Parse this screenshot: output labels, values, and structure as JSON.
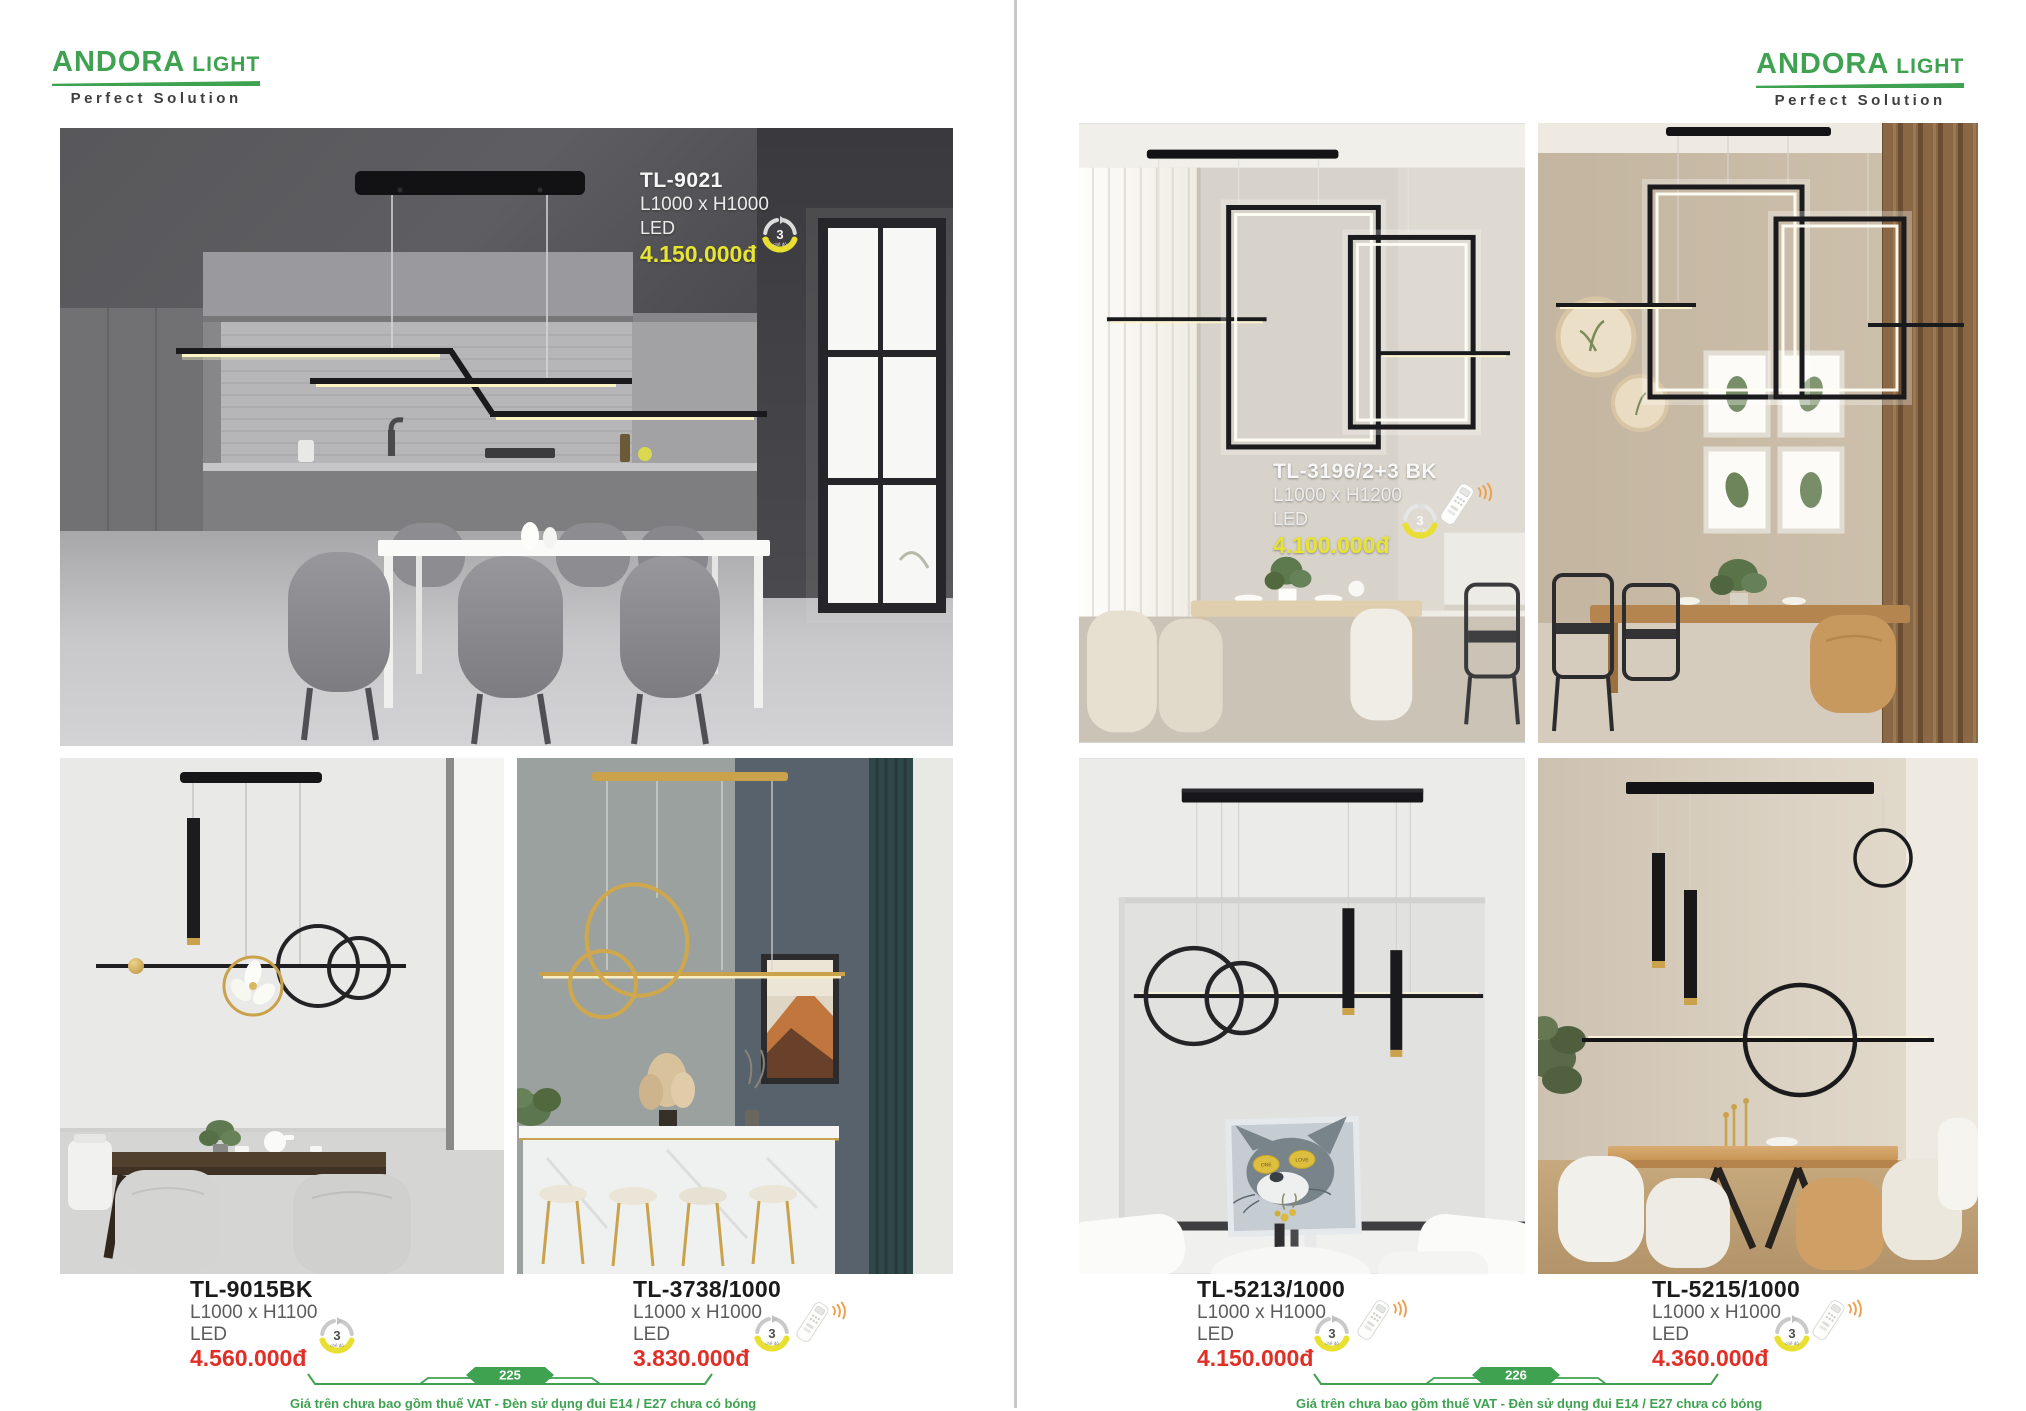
{
  "brand": {
    "name": "ANDORA",
    "suffix": "LIGHT",
    "tagline": "Perfect Solution"
  },
  "badge": {
    "value": "3",
    "label": "chế độ"
  },
  "colors": {
    "green": "#3fa251",
    "red": "#df2f26",
    "yellow": "#e8e432",
    "remote_wave_orange": "#eda14e",
    "gold": "#c9a24b"
  },
  "left_page": {
    "page_number": "225",
    "disclaimer": "Giá trên chưa bao gồm thuế VAT - Đèn sử dụng đui E14 / E27 chưa có bóng",
    "hero_product": {
      "code": "TL-9021",
      "size": "L1000 x H1000",
      "lamp": "LED",
      "price": "4.150.000đ"
    },
    "products": [
      {
        "code": "TL-9015BK",
        "size": "L1000 x H1100",
        "lamp": "LED",
        "price": "4.560.000đ"
      },
      {
        "code": "TL-3738/1000",
        "size": "L1000 x H1000",
        "lamp": "LED",
        "price": "3.830.000đ"
      }
    ]
  },
  "right_page": {
    "page_number": "226",
    "disclaimer": "Giá trên chưa bao gồm thuế VAT - Đèn sử dụng đui E14 / E27 chưa có bóng",
    "hero_product": {
      "code": "TL-3196/2+3 BK",
      "size": "L1000 x H1200",
      "lamp": "LED",
      "price": "4.100.000đ"
    },
    "products": [
      {
        "code": "TL-5213/1000",
        "size": "L1000 x H1000",
        "lamp": "LED",
        "price": "4.150.000đ"
      },
      {
        "code": "TL-5215/1000",
        "size": "L1000 x H1000",
        "lamp": "LED",
        "price": "4.360.000đ"
      }
    ]
  }
}
